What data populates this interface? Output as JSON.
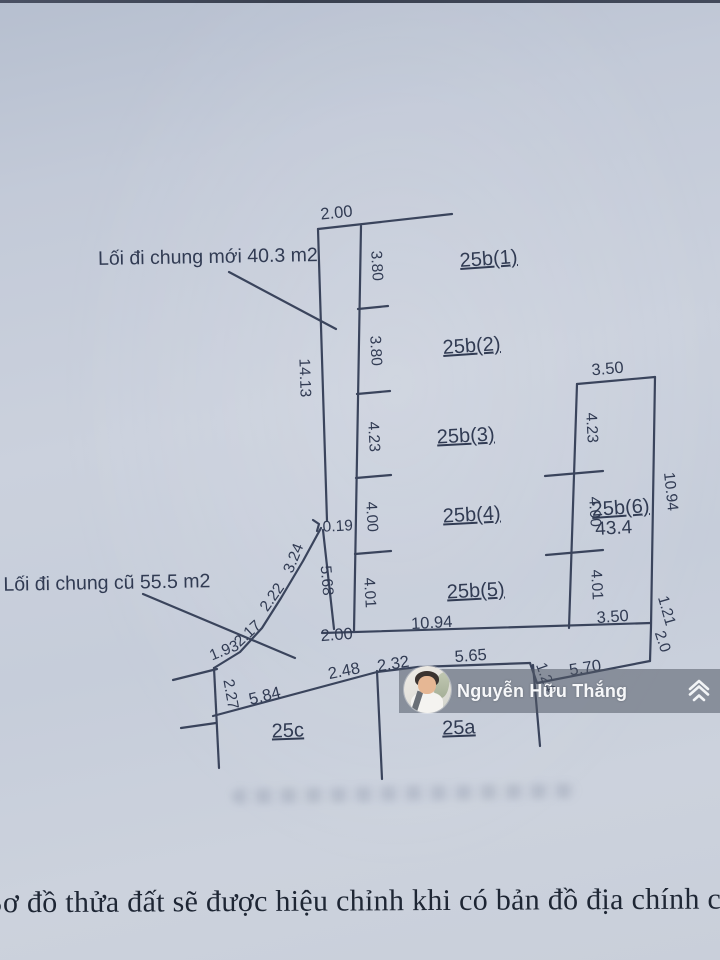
{
  "caption": {
    "text": "Sơ đồ thửa đất sẽ được hiệu chỉnh khi có bản đồ địa chính chính quy"
  },
  "watermark": {
    "name": "Nguyễn Hữu Thắng",
    "logo_icon": "diamond-chevrons-icon"
  },
  "diagram": {
    "annotations": {
      "new_path": "Lối đi chung mới 40.3 m2",
      "old_path": "Lối đi chung cũ 55.5 m2"
    },
    "plots": {
      "p1": "25b(1)",
      "p2": "25b(2)",
      "p3": "25b(3)",
      "p4": "25b(4)",
      "p5": "25b(5)",
      "p6": "25b(6)",
      "p6_area": "43.4",
      "pa": "25a",
      "pc": "25c"
    },
    "labels": {
      "top_width": "2.00",
      "col_s1": "3.80",
      "col_s2": "3.80",
      "col_s3": "4.23",
      "col_s4": "4.00",
      "col_s5": "4.01",
      "left_main": "14.13",
      "left_jog": "0.19",
      "left_lower": "5.68",
      "bottom_left_width": "2.00",
      "bottom_width": "10.94",
      "bottom_right_width": "3.50",
      "top_right_width": "3.50",
      "r_s3": "4.23",
      "r_s4": "4.00",
      "r_s5": "4.01",
      "right_edge": "10.94",
      "right_low_a": "1.21",
      "right_low_b": "2.0",
      "curve_s1": "3.24",
      "curve_s2": "2.22",
      "curve_s3": "2.17",
      "curve_s4": "1.93",
      "west": "2.27",
      "road_1": "5.84",
      "road_2": "2.48",
      "road_3": "2.32",
      "road_4": "5.65",
      "road_jog": "1.24",
      "road_5": "5.70"
    }
  }
}
